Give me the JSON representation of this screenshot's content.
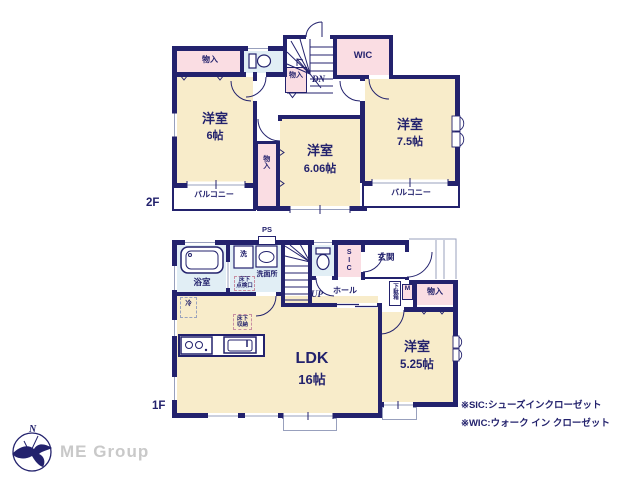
{
  "colors": {
    "wall_navy": "#23226d",
    "room_cream": "#f8ecca",
    "closet_pink": "#fadde3",
    "wet_blue": "#e1eef5",
    "outline_gray": "#98a0bd",
    "logo_gray": "#c9c9c9"
  },
  "f2": {
    "floor_label": "2F",
    "closet_top": "物入",
    "closet_stair": "物入",
    "closet_mid": "物入",
    "wic": "WIC",
    "dn": "DN",
    "room6": {
      "name": "洋室",
      "size": "6帖"
    },
    "room606": {
      "name": "洋室",
      "size": "6.06帖"
    },
    "room75": {
      "name": "洋室",
      "size": "7.5帖"
    },
    "balcony_left": "バルコニー",
    "balcony_right": "バルコニー"
  },
  "f1": {
    "floor_label": "1F",
    "ps": "PS",
    "bath": "浴室",
    "laundry": "洗",
    "washroom": "洗面所",
    "underfloor_hatch": "床下\n点検口",
    "up": "UP",
    "hall": "ホール",
    "sic": "SIC",
    "entrance": "玄関",
    "shoe_box": "下駄箱",
    "meter": "M",
    "closet": "物入",
    "fridge": "冷",
    "underfloor_storage": "床下\n収納",
    "ldk": {
      "name": "LDK",
      "size": "16帖"
    },
    "room525": {
      "name": "洋室",
      "size": "5.25帖"
    }
  },
  "footer": {
    "compass_n": "N",
    "logo": "ME Group",
    "note_sic": "※SIC:シューズインクローゼット",
    "note_wic": "※WIC:ウォーク イン クローゼット"
  }
}
